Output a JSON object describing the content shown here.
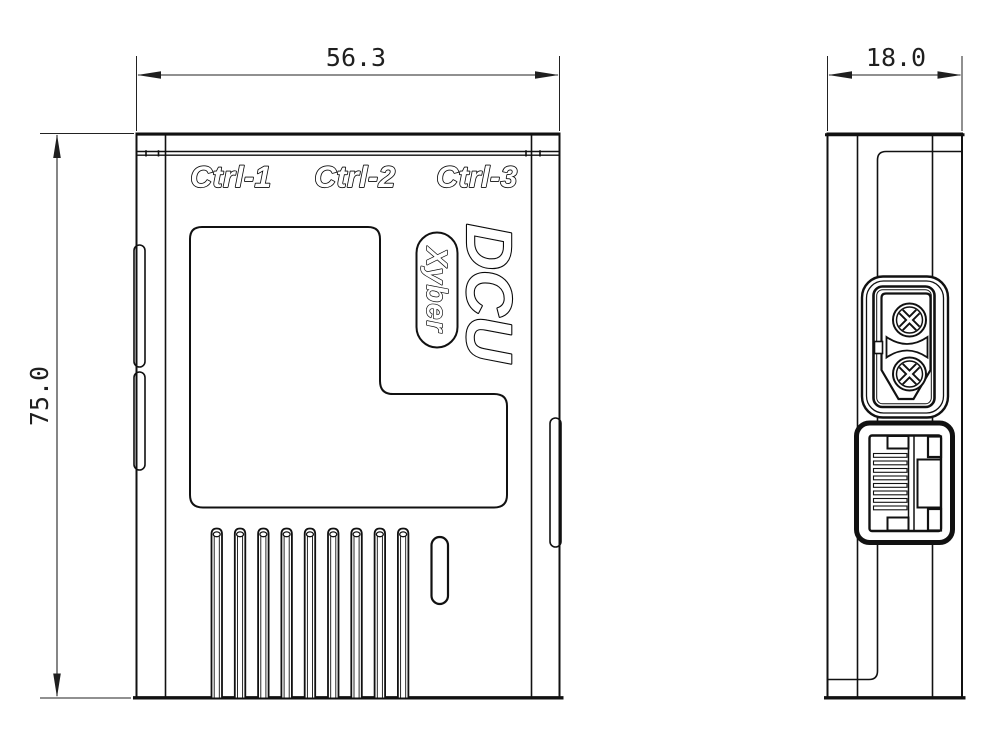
{
  "front_view": {
    "port_labels": [
      "Ctrl-1",
      "Ctrl-2",
      "Ctrl-3"
    ],
    "product_name": "DCU",
    "brand_badge": "Xyber"
  },
  "dimensions": {
    "front_width_mm": "56.3",
    "front_height_mm": "75.0",
    "side_depth_mm": "18.0"
  },
  "colors": {
    "line_color": "#111111",
    "background": "#ffffff",
    "dimension_text": "#1f1f1f"
  }
}
